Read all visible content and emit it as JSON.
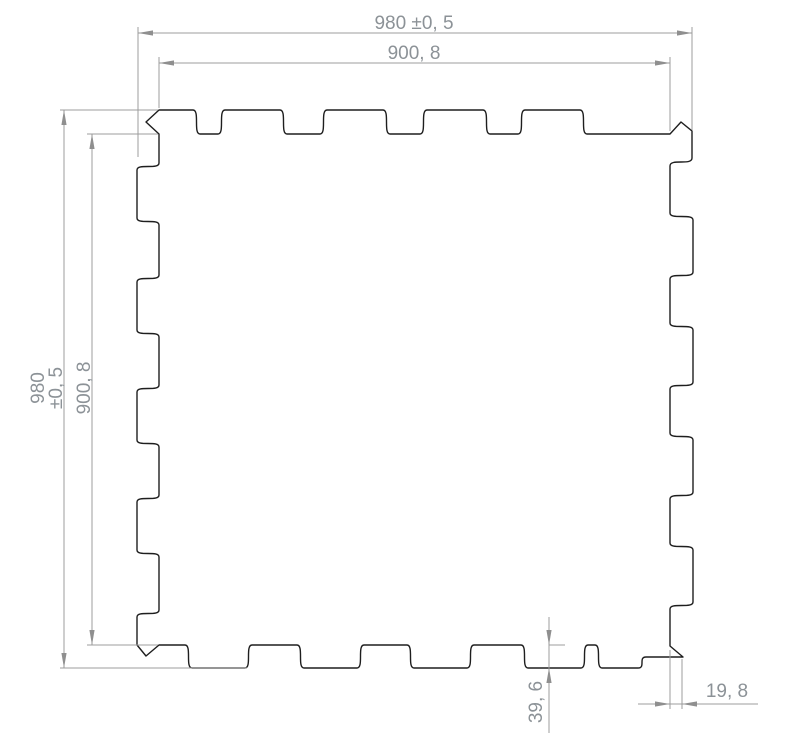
{
  "page": {
    "background": "#ffffff"
  },
  "drawing": {
    "type": "technical-drawing",
    "subject": "interlocking-puzzle-tile",
    "colors": {
      "outline": "#1e1e1e",
      "dim_line": "#9c9c9c",
      "arrow": "#8f8f8f",
      "text": "#8c9297"
    },
    "stroke": {
      "outline_width": 1.4,
      "dim_width": 1
    },
    "font_size": 19,
    "tile": {
      "outer": {
        "xL": 137,
        "yT": 110,
        "xR": 693,
        "yB": 668
      },
      "valley": {
        "xL": 159,
        "yT": 134,
        "xR": 670,
        "yB": 645
      },
      "g": 7,
      "tl_flat_end": 193,
      "tl_notch": [
        146,
        122
      ],
      "top_tabs": [
        [
          225,
          280
        ],
        [
          327,
          383
        ],
        [
          427,
          483
        ],
        [
          525,
          580
        ]
      ],
      "tr_peak": [
        [
          681,
          122
        ],
        [
          692,
          131
        ],
        [
          692,
          158
        ]
      ],
      "tr_valley_y": 166,
      "right_tabs": [
        [
          220,
          272
        ],
        [
          330,
          382
        ],
        [
          440,
          492
        ],
        [
          550,
          602
        ]
      ],
      "br_diag_top_y": 646,
      "br_outer": [
        683,
        657
      ],
      "br_ledge_left": 646,
      "bottom_tabs": [
        [
          192,
          245
        ],
        [
          304,
          357
        ],
        [
          414,
          467
        ],
        [
          528,
          581
        ],
        [
          602,
          638
        ]
      ],
      "bl_notch": [
        146,
        656
      ],
      "bl_flat_start": 617,
      "left_tabs": [
        [
          170,
          218
        ],
        [
          282,
          330
        ],
        [
          392,
          440
        ],
        [
          502,
          550
        ]
      ]
    },
    "dimensions": [
      {
        "id": "top-overall",
        "value": "980 ±0, 5",
        "line": [
          138,
          33,
          692,
          33
        ],
        "arrows": [
          {
            "tip": [
              138,
              33
            ],
            "dir": "l"
          },
          {
            "tip": [
              692,
              33
            ],
            "dir": "r"
          }
        ],
        "exts": [
          [
            138,
            27,
            138,
            157
          ],
          [
            692,
            27,
            692,
            130
          ]
        ],
        "texts": [
          {
            "t": "980 ±0, 5",
            "x": 414,
            "y": 29,
            "rot": 0
          }
        ]
      },
      {
        "id": "top-inner",
        "value": "900, 8",
        "line": [
          159,
          63,
          670,
          63
        ],
        "arrows": [
          {
            "tip": [
              159,
              63
            ],
            "dir": "l"
          },
          {
            "tip": [
              670,
              63
            ],
            "dir": "r"
          }
        ],
        "exts": [
          [
            159,
            57,
            159,
            108
          ],
          [
            670,
            57,
            670,
            131
          ]
        ],
        "texts": [
          {
            "t": "900, 8",
            "x": 414,
            "y": 59,
            "rot": 0
          }
        ]
      },
      {
        "id": "left-overall",
        "value": "980 ±0, 5",
        "line": [
          64,
          110,
          64,
          668
        ],
        "arrows": [
          {
            "tip": [
              64,
              110
            ],
            "dir": "u"
          },
          {
            "tip": [
              64,
              668
            ],
            "dir": "d"
          }
        ],
        "exts": [
          [
            60,
            110,
            158,
            110
          ],
          [
            60,
            668,
            247,
            668
          ]
        ],
        "texts": [
          {
            "t": "980",
            "x": 44,
            "y": 388,
            "rot": -90
          },
          {
            "t": "±0, 5",
            "x": 62,
            "y": 388,
            "rot": -90
          }
        ]
      },
      {
        "id": "left-inner",
        "value": "900, 8",
        "line": [
          92,
          134,
          92,
          645
        ],
        "arrows": [
          {
            "tip": [
              92,
              134
            ],
            "dir": "u"
          },
          {
            "tip": [
              92,
              645
            ],
            "dir": "d"
          }
        ],
        "exts": [
          [
            87,
            134,
            158,
            134
          ],
          [
            87,
            645,
            158,
            645
          ]
        ],
        "texts": [
          {
            "t": "900, 8",
            "x": 90,
            "y": 388,
            "rot": -90
          }
        ]
      },
      {
        "id": "tab-depth",
        "value": "39, 6",
        "line": [
          549,
          617,
          549,
          733
        ],
        "arrows": [
          {
            "tip": [
              549,
              645
            ],
            "dir": "d"
          },
          {
            "tip": [
              549,
              668
            ],
            "dir": "u"
          }
        ],
        "exts": [
          [
            549,
            645,
            565,
            645
          ]
        ],
        "texts": [
          {
            "t": "39, 6",
            "x": 542,
            "y": 702,
            "rot": -90
          }
        ]
      },
      {
        "id": "corner-width",
        "value": "19, 8",
        "line": [
          638,
          704,
          758,
          704
        ],
        "arrows": [
          {
            "tip": [
              670,
              704
            ],
            "dir": "r"
          },
          {
            "tip": [
              682,
              704
            ],
            "dir": "l"
          }
        ],
        "exts": [
          [
            670,
            650,
            670,
            709
          ],
          [
            682,
            659,
            682,
            709
          ]
        ],
        "texts": [
          {
            "t": "19, 8",
            "x": 727,
            "y": 697,
            "rot": 0
          }
        ]
      }
    ]
  }
}
